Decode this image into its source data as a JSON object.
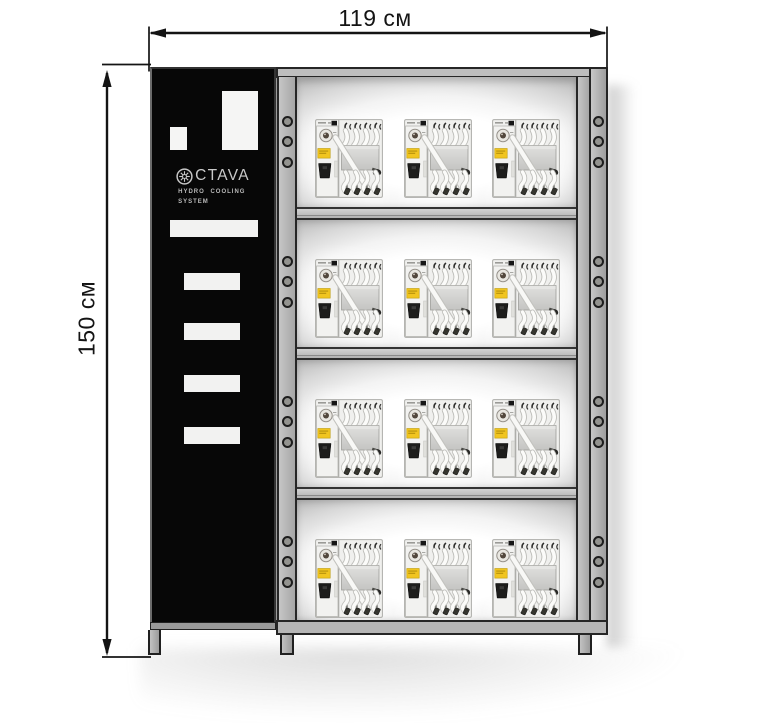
{
  "dimensions": {
    "width": {
      "label": "119 см"
    },
    "height": {
      "label": "150 см"
    }
  },
  "panel": {
    "brand": "OCTAVA",
    "logo_letters": "CTAVA",
    "logo_icon": "gear-ring-icon",
    "subtitle_line1": "HYDRO COOLING",
    "subtitle_line2": "SYSTEM"
  },
  "rack": {
    "shelves": 4,
    "units_per_shelf": 3,
    "holes_per_shelf_side": 3,
    "unit_name": "hydro-cooling-unit"
  },
  "colors": {
    "frame_gray": "#b4b4b4",
    "panel_black": "#070707",
    "outline_dark": "#1f1f1f",
    "unit_label_yellow": "#f1c51f",
    "dimension_line": "#141414",
    "cutout_white": "#f5f5f4"
  }
}
